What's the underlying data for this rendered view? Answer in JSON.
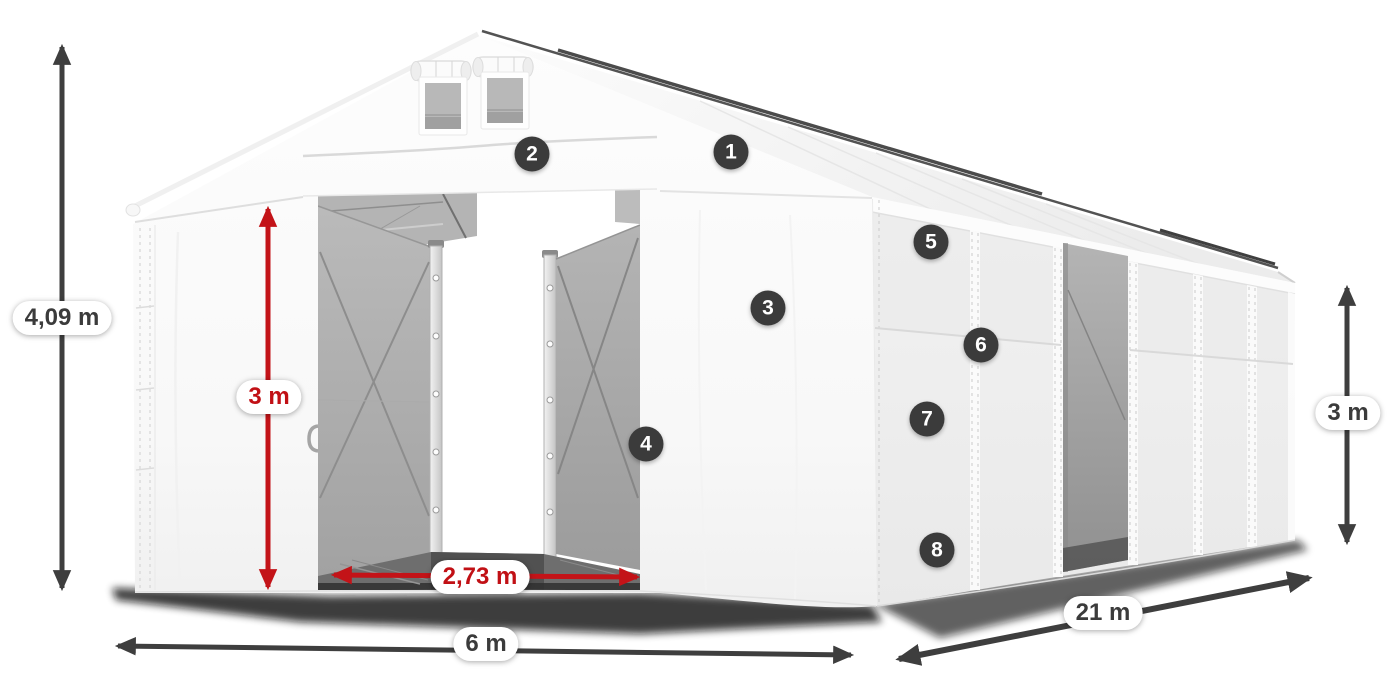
{
  "dimensions": {
    "total_height": {
      "label": "4,09 m",
      "color": "dark"
    },
    "door_height": {
      "label": "3 m",
      "color": "red"
    },
    "door_width": {
      "label": "2,73 m",
      "color": "red"
    },
    "front_width": {
      "label": "6 m",
      "color": "dark"
    },
    "length": {
      "label": "21 m",
      "color": "dark"
    },
    "side_height": {
      "label": "3 m",
      "color": "dark"
    }
  },
  "callouts": [
    {
      "number": "1"
    },
    {
      "number": "2"
    },
    {
      "number": "3"
    },
    {
      "number": "4"
    },
    {
      "number": "5"
    },
    {
      "number": "6"
    },
    {
      "number": "7"
    },
    {
      "number": "8"
    }
  ],
  "colors": {
    "dimension_red": "#c11015",
    "annotation_dark": "#3b3b3b",
    "badge_background": "#3b3b3b"
  }
}
